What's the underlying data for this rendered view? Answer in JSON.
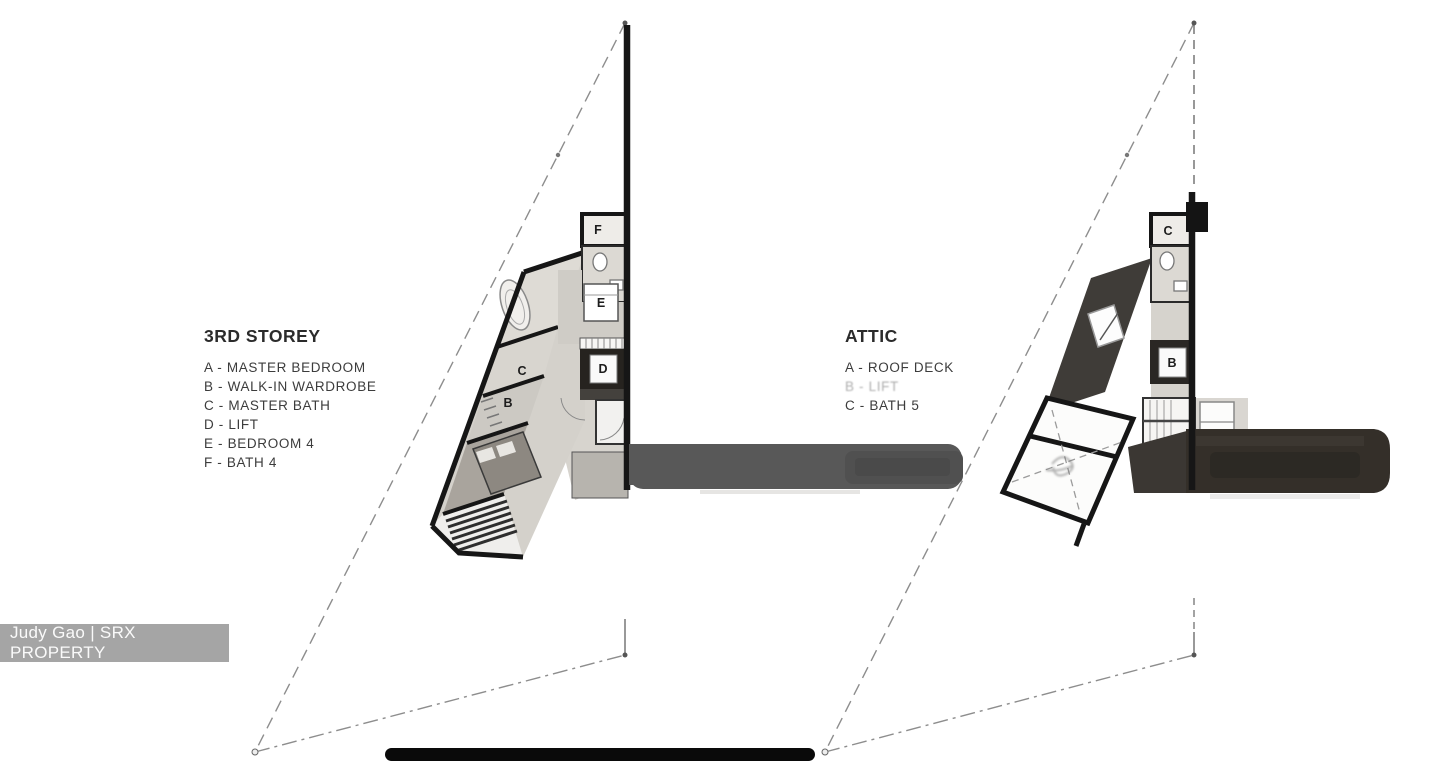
{
  "legend_left": {
    "title": "3RD STOREY",
    "items": [
      "A - MASTER BEDROOM",
      "B - WALK-IN WARDROBE",
      "C - MASTER BATH",
      "D - LIFT",
      "E - BEDROOM 4",
      "F - BATH 4"
    ]
  },
  "legend_right": {
    "title": "ATTIC",
    "items": [
      "A - ROOF DECK",
      "B - LIFT",
      "C - BATH 5"
    ]
  },
  "watermark": {
    "text": "Judy Gao | SRX PROPERTY"
  },
  "plans": {
    "third_storey": {
      "rooms": {
        "b": "B",
        "c": "C",
        "d": "D",
        "e": "E",
        "f": "F"
      }
    },
    "attic": {
      "rooms": {
        "b": "B",
        "c": "C"
      }
    }
  },
  "colors": {
    "background": "#ffffff",
    "wall": "#161616",
    "room_light": "#d7d4ce",
    "room_mid": "#ccc9c3",
    "roof_dark": "#3b3733",
    "terrace_arm": "#585858",
    "attic_bar": "#342f29",
    "site_line": "#8d8d8d",
    "scale_bar": "#0a0a0a",
    "watermark_bg": "#989898",
    "watermark_text": "#fafafa",
    "legend_text": "#3c3c3c"
  }
}
